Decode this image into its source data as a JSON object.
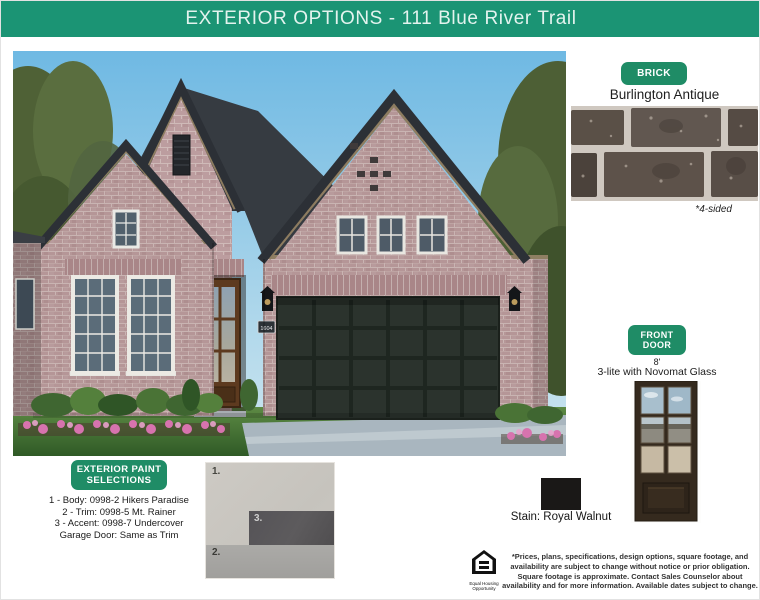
{
  "header": {
    "title": "EXTERIOR OPTIONS - 111 Blue River Trail"
  },
  "colors": {
    "brand_green": "#1b9474",
    "badge_green": "#1f8c66",
    "stain_swatch": "#1a1817"
  },
  "brick": {
    "badge": "BRICK",
    "name": "Burlington Antique",
    "note": "*4-sided"
  },
  "front_door": {
    "badge": "FRONT DOOR",
    "size": "8'",
    "description": "3-lite with Novomat Glass",
    "stain": "Stain: Royal Walnut"
  },
  "paint": {
    "badge": "EXTERIOR PAINT SELECTIONS",
    "lines": [
      "1 - Body: 0998-2 Hikers Paradise",
      "2 - Trim: 0998-5 Mt. Rainer",
      "3 - Accent: 0998-7 Undercover",
      "Garage Door: Same as Trim"
    ],
    "swatch_labels": [
      "1.",
      "2.",
      "3."
    ]
  },
  "house": {
    "number": "1604"
  },
  "footer": {
    "equal_housing": "Equal Housing Opportunity",
    "disclaimer": "*Prices, plans, specifications, design options, square footage, and availability are subject to change without notice or prior obligation. Square footage is approximate. Contact Sales Counselor about availability and for more information. Available dates subject to change."
  }
}
